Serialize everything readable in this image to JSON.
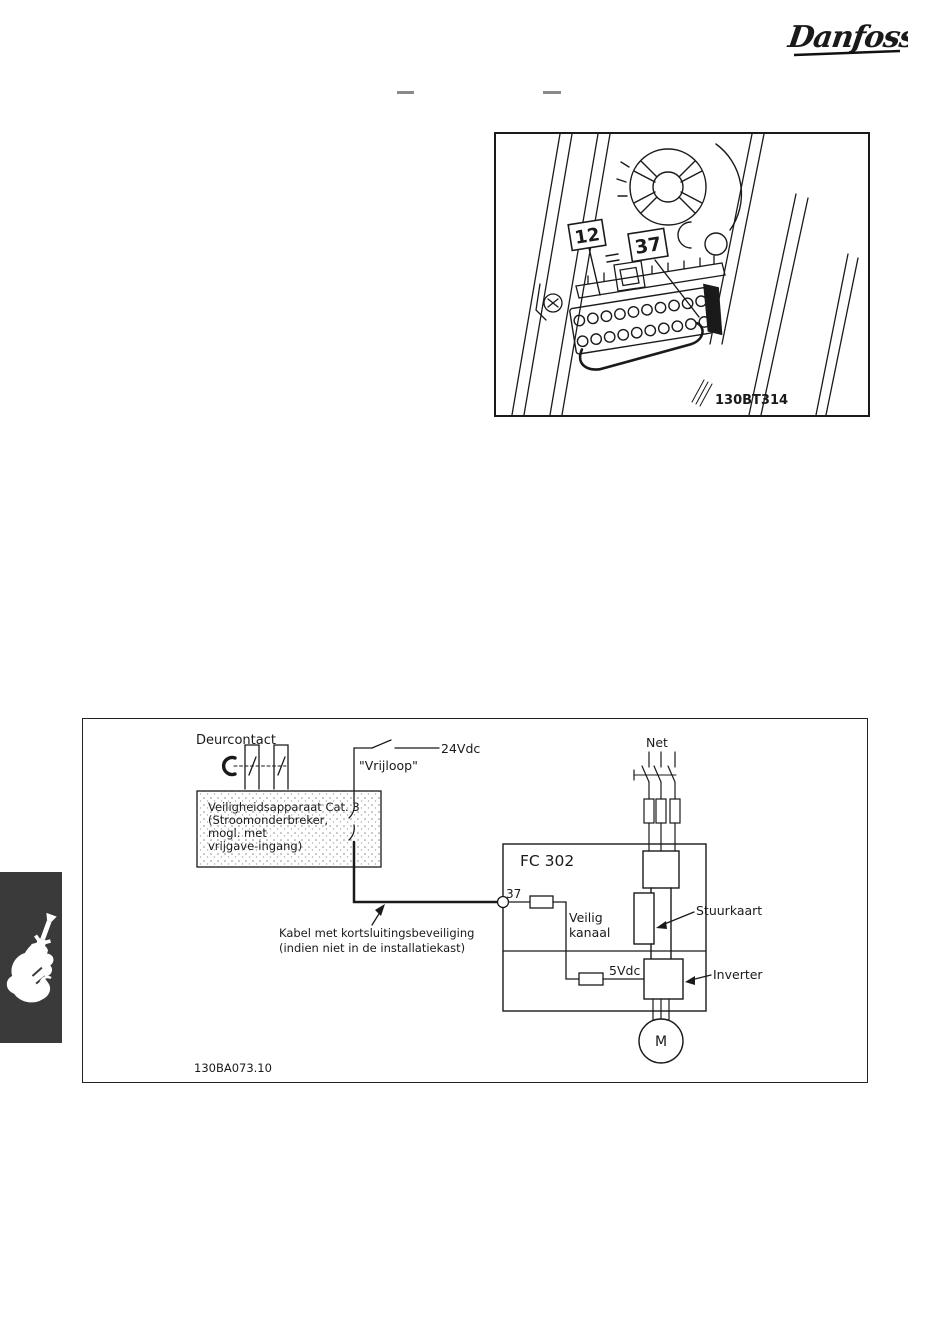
{
  "logo": {
    "brand": "Danfoss"
  },
  "figure_terminals": {
    "callout_12": "12",
    "callout_37": "37",
    "image_ref": "130BT314"
  },
  "figure_wiring": {
    "image_ref": "130BA073.10",
    "door_contact": "Deurcontact",
    "voltage_24v": "24Vdc",
    "coast_label": "\"Vrijloop\"",
    "safety_box_line1": "Veiligheidsapparaat Cat. 3",
    "safety_box_line2": "(Stroomonderbreker,",
    "safety_box_line3": "mogl. met",
    "safety_box_line4": "vrijgave-ingang)",
    "cable_note_line1": "Kabel met kortsluitingsbeveiliging",
    "cable_note_line2": "(indien niet in de installatiekast)",
    "drive_name": "FC 302",
    "terminal_number": "37",
    "safe_channel_line1": "Veilig",
    "safe_channel_line2": "kanaal",
    "control_card": "Stuurkaart",
    "voltage_5v": "5Vdc",
    "inverter": "Inverter",
    "mains": "Net",
    "motor": "M"
  },
  "sidebar_tab": {
    "icon": "hand-screwdriver-icon"
  },
  "colors": {
    "ink": "#1a1a1a",
    "tab_bg": "#3a3a3a",
    "dash_mark": "#8a8a8a"
  }
}
